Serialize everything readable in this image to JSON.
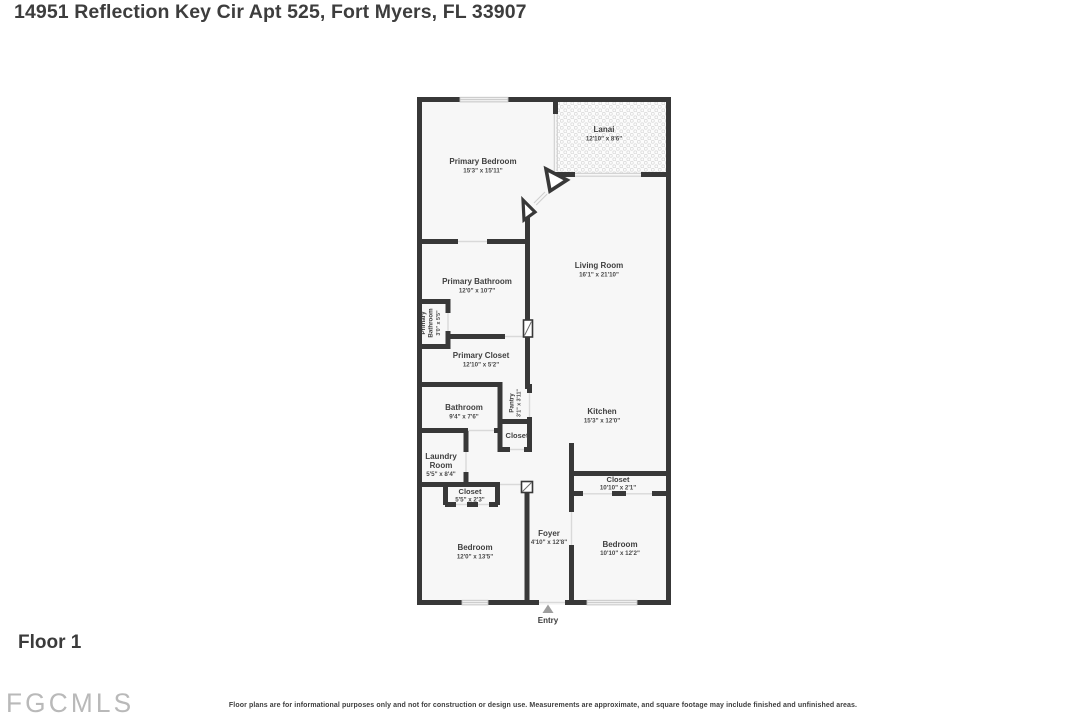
{
  "header": {
    "title": "14951 Reflection Key Cir Apt 525, Fort Myers, FL 33907"
  },
  "floor": {
    "label": "Floor 1"
  },
  "footer": {
    "logo": "FGCMLS",
    "disclaimer": "Floor plans are for informational purposes only and not for construction or design use. Measurements are approximate, and square footage may include finished and unfinished areas."
  },
  "entry": {
    "label": "Entry"
  },
  "rooms": {
    "primary_bedroom": {
      "name": "Primary Bedroom",
      "dims": "15'3\" x 15'11\""
    },
    "lanai": {
      "name": "Lanai",
      "dims": "12'10\" x 8'6\""
    },
    "living_room": {
      "name": "Living Room",
      "dims": "16'1\" x 21'10\""
    },
    "primary_bathroom": {
      "name": "Primary Bathroom",
      "dims": "12'0\" x 10'7\""
    },
    "primary_bathroom_small": {
      "line1": "Primary",
      "line2": "Bathroom",
      "dims": "3'0\" x 5'5\""
    },
    "primary_closet": {
      "name": "Primary Closet",
      "dims": "12'10\" x 5'2\""
    },
    "bathroom": {
      "name": "Bathroom",
      "dims": "9'4\" x 7'6\""
    },
    "pantry": {
      "name": "Pantry",
      "dims": "3'1\" x 3'11\""
    },
    "hall_closet": {
      "name": "Closet"
    },
    "laundry_room": {
      "line1": "Laundry",
      "line2": "Room",
      "dims": "5'5\" x 8'4\""
    },
    "closet_small": {
      "name": "Closet",
      "dims": "5'5\" x 2'3\""
    },
    "kitchen": {
      "name": "Kitchen",
      "dims": "15'3\" x 12'0\""
    },
    "bedroom2_closet": {
      "name": "Closet",
      "dims": "10'10\" x 2'1\""
    },
    "bedroom_left": {
      "name": "Bedroom",
      "dims": "12'0\" x 13'5\""
    },
    "foyer": {
      "name": "Foyer",
      "dims": "4'10\" x 12'8\""
    },
    "bedroom_right": {
      "name": "Bedroom",
      "dims": "10'10\" x 12'2\""
    }
  },
  "colors": {
    "wall": "#383838",
    "room_fill": "#f7f7f7",
    "label_text": "#3f3f3f",
    "logo_gray": "#b9b9b9",
    "entry_arrow": "#9e9e9e"
  }
}
